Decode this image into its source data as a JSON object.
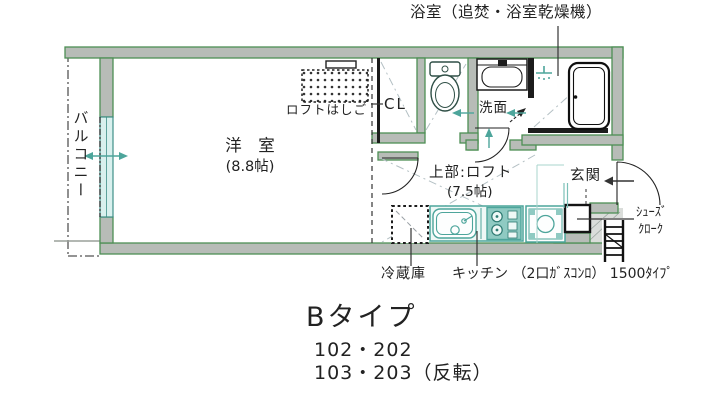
{
  "plan": {
    "bathroom_callout": "浴室（追焚・浴室乾燥機）",
    "balcony": "バルコニー",
    "western_room": "洋　室",
    "western_room_size": "(8.8帖)",
    "loft_ladder": "ロフトはしご",
    "closet": "CL",
    "washroom": "洗面",
    "upper_loft": "上部:ロフト",
    "upper_loft_size": "(7.5帖)",
    "entrance": "玄関",
    "shoe_closet_line1": "ｼｭｰｽﾞ",
    "shoe_closet_line2": "ｸﾛｰｸ",
    "refrigerator": "冷蔵庫",
    "kitchen": "キッチン （2口ｶﾞｽｺﾝﾛ） 1500ﾀｲﾌﾟ"
  },
  "caption": {
    "type_label": "Bタイプ",
    "units_line1": "102・202",
    "units_line2": "103・203（反転）"
  },
  "colors": {
    "wall_green": "#4d8f55",
    "wall_gray": "#b7bcb7",
    "fixture_teal": "#4da59b",
    "stove_teal": "#8fcac2",
    "window_cyan": "#d9f0ee",
    "line_black": "#1c1c1c"
  }
}
